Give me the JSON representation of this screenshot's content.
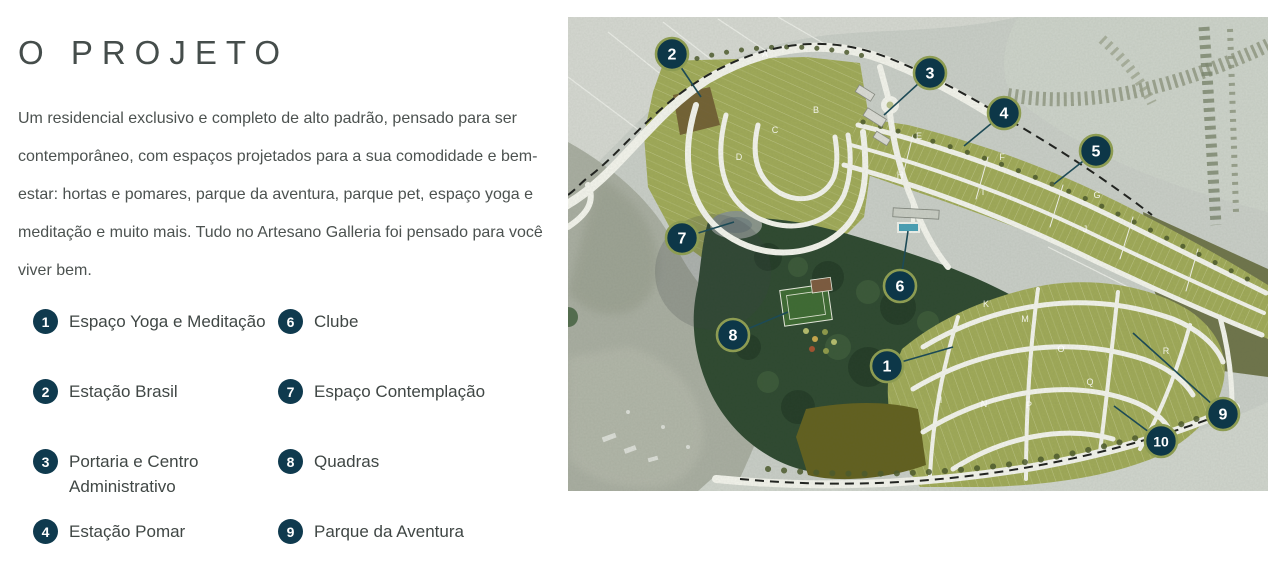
{
  "header": {
    "title": "O PROJETO"
  },
  "intro": {
    "text": "Um residencial exclusivo e completo de alto padrão, pensado para ser contemporâneo, com espaços projetados para a sua comodidade e bem-estar: hortas e pomares, parque da aventura, parque pet, espaço yoga e meditação e muito mais. Tudo no Artesano Galleria foi pensado para você viver bem."
  },
  "legend": {
    "badge_color": "#0f3a4e",
    "columns": [
      {
        "items": [
          {
            "num": "1",
            "label": "Espaço Yoga e Meditação"
          },
          {
            "num": "2",
            "label": "Estação Brasil"
          },
          {
            "num": "3",
            "label": "Portaria e Centro Administrativo"
          },
          {
            "num": "4",
            "label": "Estação Pomar"
          }
        ]
      },
      {
        "items": [
          {
            "num": "6",
            "label": "Clube"
          },
          {
            "num": "7",
            "label": "Espaço Contemplação"
          },
          {
            "num": "8",
            "label": "Quadras"
          },
          {
            "num": "9",
            "label": "Parque da Aventura"
          }
        ]
      }
    ]
  },
  "map": {
    "colors": {
      "marker_fill": "#0d3748",
      "marker_ring": "#8d9c52",
      "leader_line": "#1d4a56"
    },
    "markers": [
      {
        "num": "1",
        "x": 319,
        "y": 349,
        "tx": 385,
        "ty": 330
      },
      {
        "num": "2",
        "x": 104,
        "y": 37,
        "tx": 133,
        "ty": 80
      },
      {
        "num": "3",
        "x": 362,
        "y": 56,
        "tx": 316,
        "ty": 98
      },
      {
        "num": "4",
        "x": 436,
        "y": 96,
        "tx": 396,
        "ty": 129
      },
      {
        "num": "5",
        "x": 528,
        "y": 134,
        "tx": 486,
        "ty": 167
      },
      {
        "num": "6",
        "x": 332,
        "y": 269,
        "tx": 340,
        "ty": 214
      },
      {
        "num": "7",
        "x": 114,
        "y": 221,
        "tx": 166,
        "ty": 205
      },
      {
        "num": "8",
        "x": 165,
        "y": 318,
        "tx": 220,
        "ty": 295
      },
      {
        "num": "9",
        "x": 655,
        "y": 397,
        "tx": 565,
        "ty": 316
      },
      {
        "num": "10",
        "x": 593,
        "y": 424,
        "tx": 546,
        "ty": 389
      }
    ],
    "block_labels": [
      {
        "letter": "A",
        "x": 197,
        "y": 40
      },
      {
        "letter": "B",
        "x": 248,
        "y": 96
      },
      {
        "letter": "C",
        "x": 207,
        "y": 116
      },
      {
        "letter": "D",
        "x": 171,
        "y": 143
      },
      {
        "letter": "E",
        "x": 351,
        "y": 122
      },
      {
        "letter": "F",
        "x": 434,
        "y": 143
      },
      {
        "letter": "G",
        "x": 529,
        "y": 181
      },
      {
        "letter": "H",
        "x": 332,
        "y": 161
      },
      {
        "letter": "I",
        "x": 415,
        "y": 178
      },
      {
        "letter": "J",
        "x": 517,
        "y": 215
      },
      {
        "letter": "K",
        "x": 418,
        "y": 290
      },
      {
        "letter": "M",
        "x": 457,
        "y": 305
      },
      {
        "letter": "O",
        "x": 493,
        "y": 335
      },
      {
        "letter": "R",
        "x": 598,
        "y": 337
      },
      {
        "letter": "Q",
        "x": 522,
        "y": 368
      },
      {
        "letter": "I",
        "x": 373,
        "y": 386
      },
      {
        "letter": "N",
        "x": 416,
        "y": 390
      },
      {
        "letter": "P",
        "x": 461,
        "y": 391
      }
    ]
  }
}
